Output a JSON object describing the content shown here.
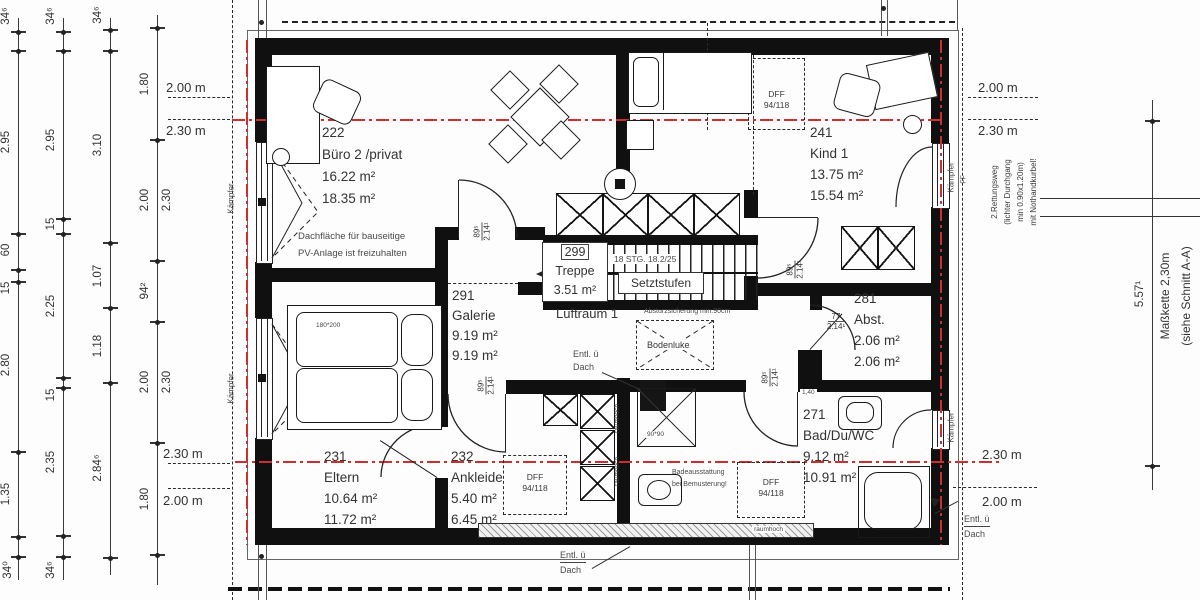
{
  "rooms": {
    "buero": {
      "id": "222",
      "name": "Büro 2 /privat",
      "area_wohn": "16.22 m²",
      "area_grund": "18.35 m²"
    },
    "kind": {
      "id": "241",
      "name": "Kind 1",
      "area_wohn": "13.75 m²",
      "area_grund": "15.54 m²"
    },
    "treppe": {
      "id": "299",
      "name": "Treppe",
      "area_wohn": "3.51 m²"
    },
    "galerie": {
      "id": "291",
      "name": "Galerie",
      "area_wohn": "9.19 m²",
      "area_grund": "9.19 m²"
    },
    "abstellraum": {
      "id": "281",
      "name": "Abst.",
      "area_wohn": "2.06 m²",
      "area_grund": "2.06 m²"
    },
    "eltern": {
      "id": "231",
      "name": "Eltern",
      "area_wohn": "10.64 m²",
      "area_grund": "11.72 m²"
    },
    "ankleide": {
      "id": "232",
      "name": "Ankleide",
      "area_wohn": "5.40 m²",
      "area_grund": "6.45 m²"
    },
    "bad": {
      "id": "271",
      "name": "Bad/Du/WC",
      "area_wohn": "9.12 m²",
      "area_grund": "10.91 m²"
    }
  },
  "annotations": {
    "pv_note": [
      "Dachfläche für bauseitige",
      "PV-Anlage ist freizuhalten"
    ],
    "dff_label": "DFF",
    "dff_size": "94/118",
    "stair_note": "18 STG. 18.2/25",
    "setztstufen": "Setztstufen",
    "luftraum": "Luftraum 1",
    "absturz": "Absturzsicherung min.90cm",
    "bodenluke": "Bodenluke",
    "entlueftung": [
      "Entl. ü",
      "Dach"
    ],
    "bad_note": [
      "Badeausstattung",
      "bei Bemusterung!"
    ],
    "raumhoch": "raumhoch",
    "kaempfer": "Kämpfer",
    "ff": "FF",
    "rettungsweg": [
      "2.Rettungsweg",
      "(lichter Durchgang",
      "min 0.90x1.20m)",
      "mit Nothandkurbel!"
    ],
    "masskette": [
      "Maßkette 2,30m",
      "(siehe Schnitt A-A)"
    ],
    "bed_size": "180*200",
    "shower_size": "90*90",
    "door_89": "89⁵",
    "door_214": "2.14¹",
    "door_77": "77",
    "door_140": "1,40"
  },
  "heights": {
    "h200": "2.00 m",
    "h230": "2.30 m"
  },
  "chains": [
    {
      "x": 18,
      "y1": 18,
      "y2": 580,
      "ticks": [
        32,
        51,
        234,
        270,
        282,
        452,
        537,
        557
      ],
      "labels": [
        {
          "y": 16,
          "t": "34⁶"
        },
        {
          "y": 142,
          "t": "2.95"
        },
        {
          "y": 250,
          "t": "60"
        },
        {
          "y": 288,
          "t": "15"
        },
        {
          "y": 365,
          "t": "2.80"
        },
        {
          "y": 494,
          "t": "1.35"
        },
        {
          "y": 570,
          "t": "34⁰"
        }
      ]
    },
    {
      "x": 63,
      "y1": 18,
      "y2": 580,
      "ticks": [
        32,
        51,
        219,
        234,
        378,
        388,
        536,
        557
      ],
      "labels": [
        {
          "y": 16,
          "t": "34⁶"
        },
        {
          "y": 140,
          "t": "2.95"
        },
        {
          "y": 224,
          "t": "15"
        },
        {
          "y": 306,
          "t": "2.25"
        },
        {
          "y": 395,
          "t": "15"
        },
        {
          "y": 462,
          "t": "2.35"
        },
        {
          "y": 570,
          "t": "34⁶"
        }
      ]
    },
    {
      "x": 110,
      "y1": 18,
      "y2": 575,
      "ticks": [
        30,
        51,
        243,
        308,
        383,
        558
      ],
      "labels": [
        {
          "y": 15,
          "t": "34⁶"
        },
        {
          "y": 145,
          "t": "3.10"
        },
        {
          "y": 276,
          "t": "1.07"
        },
        {
          "y": 346,
          "t": "1.18"
        },
        {
          "y": 468,
          "t": "2.84⁶"
        }
      ]
    },
    {
      "x": 157,
      "y1": 15,
      "y2": 585,
      "ticks": [
        28,
        140,
        261,
        322,
        443,
        555
      ],
      "labels": [
        {
          "y": 84,
          "t": "1.80"
        },
        {
          "y": 200,
          "t": "2.00"
        },
        {
          "y": 200,
          "t": "2.30",
          "side": "r"
        },
        {
          "y": 291,
          "t": "94²"
        },
        {
          "y": 382,
          "t": "2.00"
        },
        {
          "y": 382,
          "t": "2.30",
          "side": "r"
        },
        {
          "y": 499,
          "t": "1.80"
        }
      ]
    },
    {
      "x": 1152,
      "y1": 100,
      "y2": 490,
      "ticks": [
        121,
        466
      ],
      "labels": [
        {
          "y": 294,
          "t": "5.57¹"
        }
      ]
    }
  ]
}
